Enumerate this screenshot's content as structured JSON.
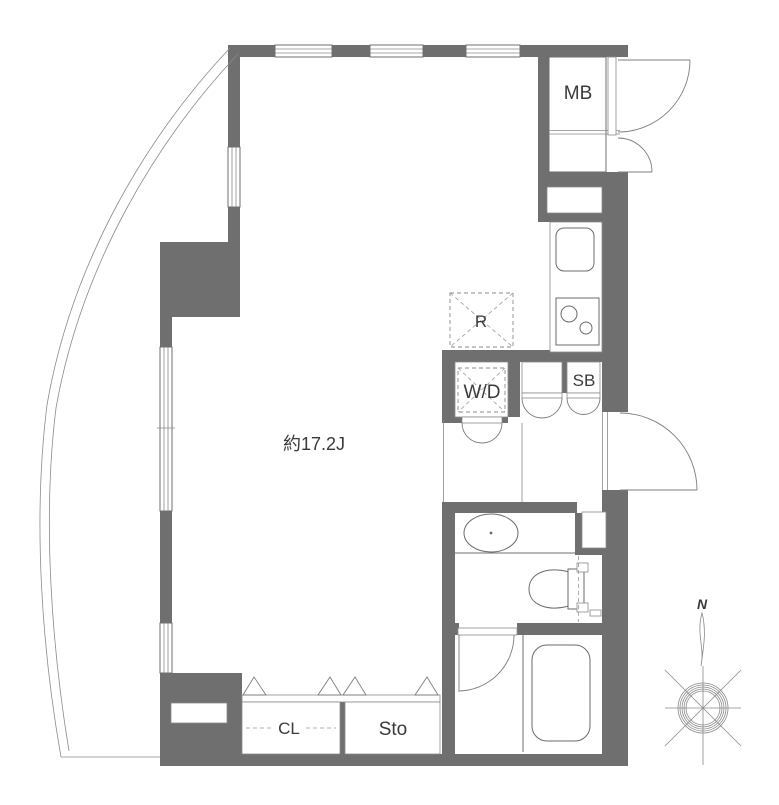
{
  "floor_plan": {
    "room_area_label": "約17.2J",
    "labels": {
      "meter_box": "MB",
      "refrigerator": "R",
      "washer_dryer": "W/D",
      "shoe_box": "SB",
      "closet": "CL",
      "storage": "Sto"
    },
    "compass": {
      "north": "N"
    },
    "colors": {
      "wall": "#6f6f6f",
      "fixture_line": "#6b6b6b",
      "dashed_line": "#9a9a9a",
      "text": "#3a3a3a",
      "background": "#ffffff"
    }
  }
}
